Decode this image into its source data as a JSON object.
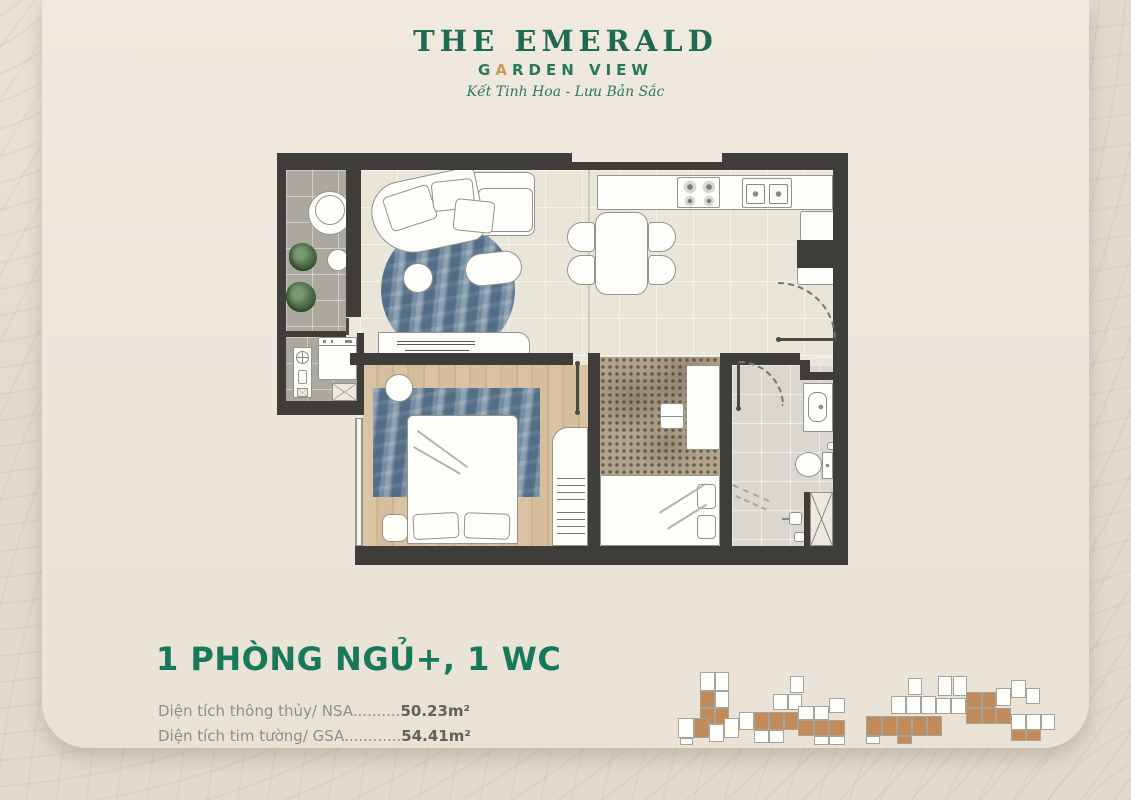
{
  "logo": {
    "title": "THE EMERALD",
    "garden_pre": "G",
    "garden_gold": "A",
    "garden_post": "RDEN VIEW",
    "tagline": "Kết Tinh Hoa - Lưu Bản Sắc",
    "green": "#1d6a50",
    "gold": "#c59a5f"
  },
  "unit": {
    "title": "1 PHÒNG NGỦ+, 1 WC",
    "title_color": "#17795a",
    "areas": [
      {
        "label": "Diện tích thông thủy/ NSA",
        "leader": "..........",
        "value": "50.23m²"
      },
      {
        "label": "Diện tích tim tường/ GSA",
        "leader": "............",
        "value": "54.41m²"
      }
    ]
  },
  "floorplan_palette": {
    "wall": "#3e3d3a",
    "living_floor": "#e9e5d9",
    "balcony_floor": "#aba99f",
    "wood_floor": "#d6bd9b",
    "bath_floor": "#d9d7cf",
    "rug_blue": "#5f7a92",
    "rug_dotted": "#b2a38c",
    "furniture": "#fdfdfa"
  },
  "site_plan": {
    "orange": "#c18a58",
    "outline": "#a5a39a",
    "clusters": [
      {
        "x": 678,
        "y": 668,
        "boxes": [
          [
            22,
            4,
            15,
            19,
            "w"
          ],
          [
            37,
            4,
            14,
            19,
            "w"
          ],
          [
            22,
            23,
            15,
            17,
            "o"
          ],
          [
            37,
            23,
            14,
            17,
            "w"
          ],
          [
            22,
            40,
            15,
            16,
            "o"
          ],
          [
            37,
            40,
            14,
            16,
            "o"
          ],
          [
            0,
            50,
            16,
            20,
            "w"
          ],
          [
            16,
            50,
            15,
            20,
            "o"
          ],
          [
            31,
            56,
            15,
            18,
            "w"
          ],
          [
            46,
            50,
            15,
            20,
            "w"
          ],
          [
            2,
            70,
            13,
            7,
            "w"
          ],
          [
            61,
            44,
            15,
            18,
            "w"
          ],
          [
            76,
            44,
            15,
            18,
            "o"
          ],
          [
            91,
            44,
            15,
            18,
            "o"
          ],
          [
            106,
            44,
            14,
            18,
            "o"
          ],
          [
            76,
            62,
            15,
            13,
            "w"
          ],
          [
            91,
            62,
            15,
            13,
            "w"
          ],
          [
            95,
            26,
            15,
            16,
            "w"
          ],
          [
            110,
            26,
            14,
            16,
            "w"
          ],
          [
            112,
            8,
            14,
            17,
            "w"
          ],
          [
            120,
            38,
            16,
            14,
            "w"
          ],
          [
            136,
            38,
            15,
            14,
            "w"
          ],
          [
            151,
            30,
            16,
            15,
            "w"
          ],
          [
            120,
            52,
            16,
            16,
            "o"
          ],
          [
            136,
            52,
            15,
            16,
            "o"
          ],
          [
            151,
            52,
            16,
            16,
            "o"
          ],
          [
            136,
            68,
            15,
            9,
            "w"
          ],
          [
            151,
            68,
            16,
            9,
            "w"
          ]
        ]
      },
      {
        "x": 866,
        "y": 666,
        "boxes": [
          [
            0,
            50,
            16,
            20,
            "o"
          ],
          [
            16,
            50,
            15,
            20,
            "o"
          ],
          [
            31,
            50,
            15,
            20,
            "o"
          ],
          [
            46,
            50,
            15,
            20,
            "o"
          ],
          [
            61,
            50,
            15,
            20,
            "o"
          ],
          [
            0,
            70,
            14,
            8,
            "w"
          ],
          [
            31,
            70,
            15,
            8,
            "o"
          ],
          [
            25,
            30,
            15,
            18,
            "w"
          ],
          [
            40,
            30,
            15,
            18,
            "w"
          ],
          [
            55,
            30,
            15,
            18,
            "w"
          ],
          [
            42,
            12,
            14,
            17,
            "w"
          ],
          [
            70,
            32,
            15,
            16,
            "w"
          ],
          [
            85,
            32,
            15,
            16,
            "w"
          ],
          [
            72,
            10,
            14,
            20,
            "w"
          ],
          [
            87,
            10,
            14,
            20,
            "w"
          ],
          [
            100,
            26,
            16,
            16,
            "o"
          ],
          [
            116,
            26,
            14,
            16,
            "o"
          ],
          [
            100,
            42,
            16,
            16,
            "o"
          ],
          [
            116,
            42,
            14,
            16,
            "o"
          ],
          [
            130,
            42,
            15,
            16,
            "o"
          ],
          [
            130,
            22,
            15,
            18,
            "w"
          ],
          [
            145,
            14,
            15,
            18,
            "w"
          ],
          [
            160,
            22,
            14,
            16,
            "w"
          ],
          [
            145,
            48,
            15,
            16,
            "w"
          ],
          [
            160,
            48,
            15,
            16,
            "w"
          ],
          [
            175,
            48,
            14,
            16,
            "w"
          ],
          [
            145,
            64,
            15,
            11,
            "o"
          ],
          [
            160,
            64,
            15,
            11,
            "o"
          ]
        ]
      }
    ]
  }
}
